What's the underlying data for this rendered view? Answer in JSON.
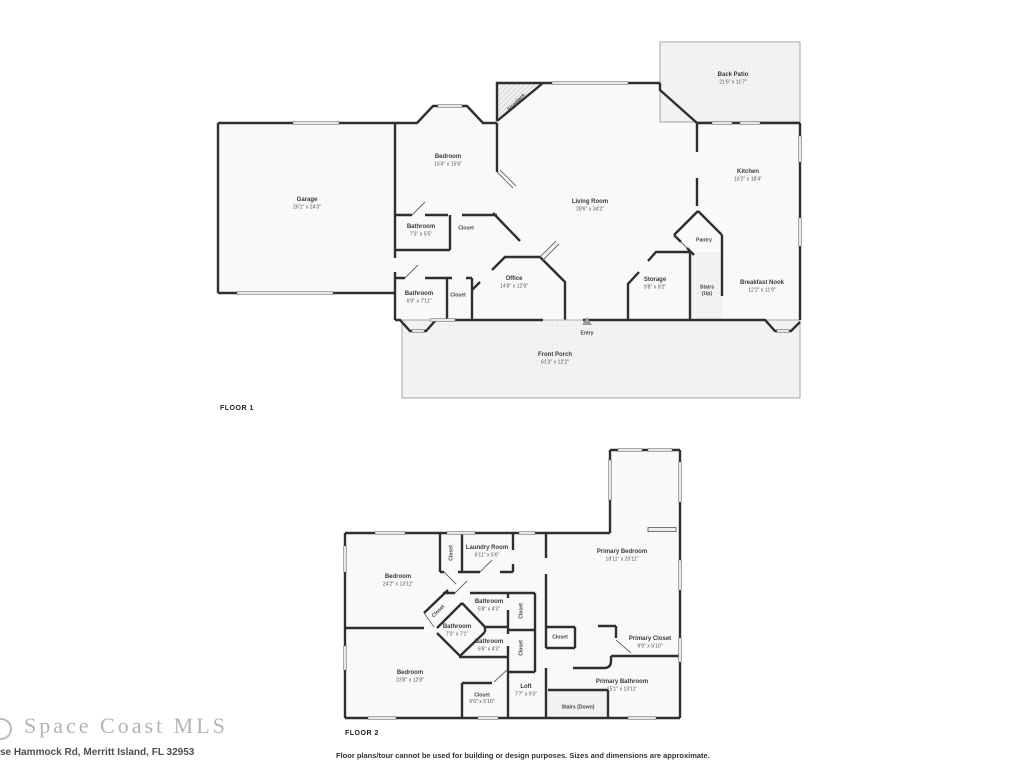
{
  "floor1": {
    "label": "FLOOR 1",
    "rooms": [
      {
        "name": "Garage",
        "dims": "26'1\" x 24'3\""
      },
      {
        "name": "Bedroom",
        "dims": "15'4\" x 15'6\""
      },
      {
        "name": "Living Room",
        "dims": "28'6\" x 34'2\""
      },
      {
        "name": "Back Patio",
        "dims": "21'6\" x 11'7\""
      },
      {
        "name": "Kitchen",
        "dims": "16'2\" x 18'4\""
      },
      {
        "name": "Bathroom",
        "dims": "7'3\" x 5'5\""
      },
      {
        "name": "Closet"
      },
      {
        "name": "Office",
        "dims": "14'8\" x 12'9\""
      },
      {
        "name": "Bathroom",
        "dims": "6'9\" x 7'11\""
      },
      {
        "name": "Closet"
      },
      {
        "name": "Storage",
        "dims": "9'8\" x 9'2\""
      },
      {
        "name": "Stairs",
        "dims": "(Up)"
      },
      {
        "name": "Pantry"
      },
      {
        "name": "Breakfast Nook",
        "dims": "12'2\" x 11'9\""
      },
      {
        "name": "Front Porch",
        "dims": "61'3\" x 12'2\""
      },
      {
        "name": "Entry"
      },
      {
        "name": "Fireplace"
      }
    ]
  },
  "floor2": {
    "label": "FLOOR 2",
    "rooms": [
      {
        "name": "Bedroom",
        "dims": "24'2\" x 13'11\""
      },
      {
        "name": "Closet"
      },
      {
        "name": "Laundry Room",
        "dims": "6'11\" x 5'6\""
      },
      {
        "name": "Primary Bedroom",
        "dims": "18'11\" x 20'11\""
      },
      {
        "name": "Closet"
      },
      {
        "name": "Bathroom",
        "dims": "6'8\" x 4'3\""
      },
      {
        "name": "Closet"
      },
      {
        "name": "Bathroom",
        "dims": "7'3\" x 7'1\""
      },
      {
        "name": "Bathroom",
        "dims": "6'6\" x 4'3\""
      },
      {
        "name": "Closet"
      },
      {
        "name": "Closet"
      },
      {
        "name": "Primary Closet",
        "dims": "9'9\" x 5'10\""
      },
      {
        "name": "Primary Bathroom",
        "dims": "15'1\" x 13'11\""
      },
      {
        "name": "Bedroom",
        "dims": "23'8\" x 12'8\""
      },
      {
        "name": "Closet",
        "dims": "6'6\" x 5'10\""
      },
      {
        "name": "Loft",
        "dims": "7'7\" x 9'3\""
      },
      {
        "name": "Stairs (Down)"
      }
    ]
  },
  "footer": {
    "logo": "Space Coast MLS",
    "address": "se Hammock Rd, Merritt Island, FL 32953",
    "disclaimer": "Floor plans/tour cannot be used for building or design purposes. Sizes and dimensions are approximate."
  }
}
